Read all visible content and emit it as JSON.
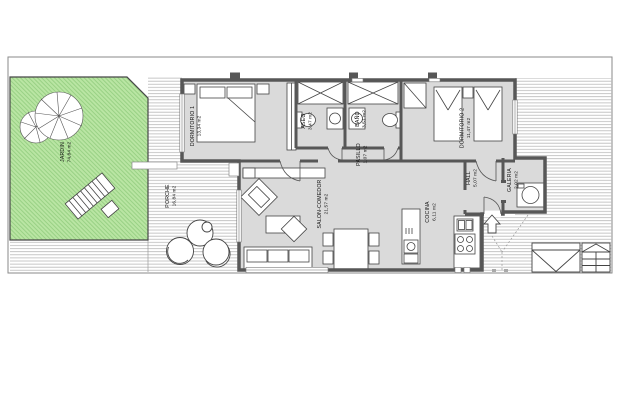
{
  "plan": {
    "type": "residential floor plan",
    "orientation_note": "room labels rotated 90 degrees",
    "rooms": [
      {
        "name": "JARDIN",
        "area": "74,84 m2"
      },
      {
        "name": "PORCHE",
        "area": "16,84 m2"
      },
      {
        "name": "DORMITORIO 1",
        "area": "13,34 m2"
      },
      {
        "name": "ASEO",
        "area": "3,47 m2"
      },
      {
        "name": "BAÑO",
        "area": "3,51 m2"
      },
      {
        "name": "PASILLO",
        "area": "1,07 m2"
      },
      {
        "name": "DORMITORIO 2",
        "area": "11,47 m2"
      },
      {
        "name": "HALL",
        "area": "5,07 m2"
      },
      {
        "name": "GALERIA",
        "area": "2,02 m2"
      },
      {
        "name": "SALON-COMEDOR",
        "area": "21,57 m2"
      },
      {
        "name": "COCINA",
        "area": "6,11 m2"
      }
    ],
    "features": [
      "garden with two trees",
      "sun lounger",
      "porch with round chairs and table",
      "double bed",
      "two single beds",
      "wardrobes",
      "showers",
      "toilets",
      "washbasins",
      "washing machine",
      "kitchen island with sink",
      "hob with 4 burners",
      "sofa",
      "armchair",
      "coffee table",
      "dining table with 4 chairs",
      "entrance arrow",
      "exterior stairs"
    ]
  },
  "colors": {
    "background": "#ffffff",
    "wall": "#575757",
    "floor": "#dadada",
    "garden_fill": "#b9e5a3",
    "garden_hatch": "#8bc878",
    "deck_line": "#b9b9b9",
    "boundary": "#8a8a8a",
    "furniture_stroke": "#444444",
    "text": "#111111"
  }
}
